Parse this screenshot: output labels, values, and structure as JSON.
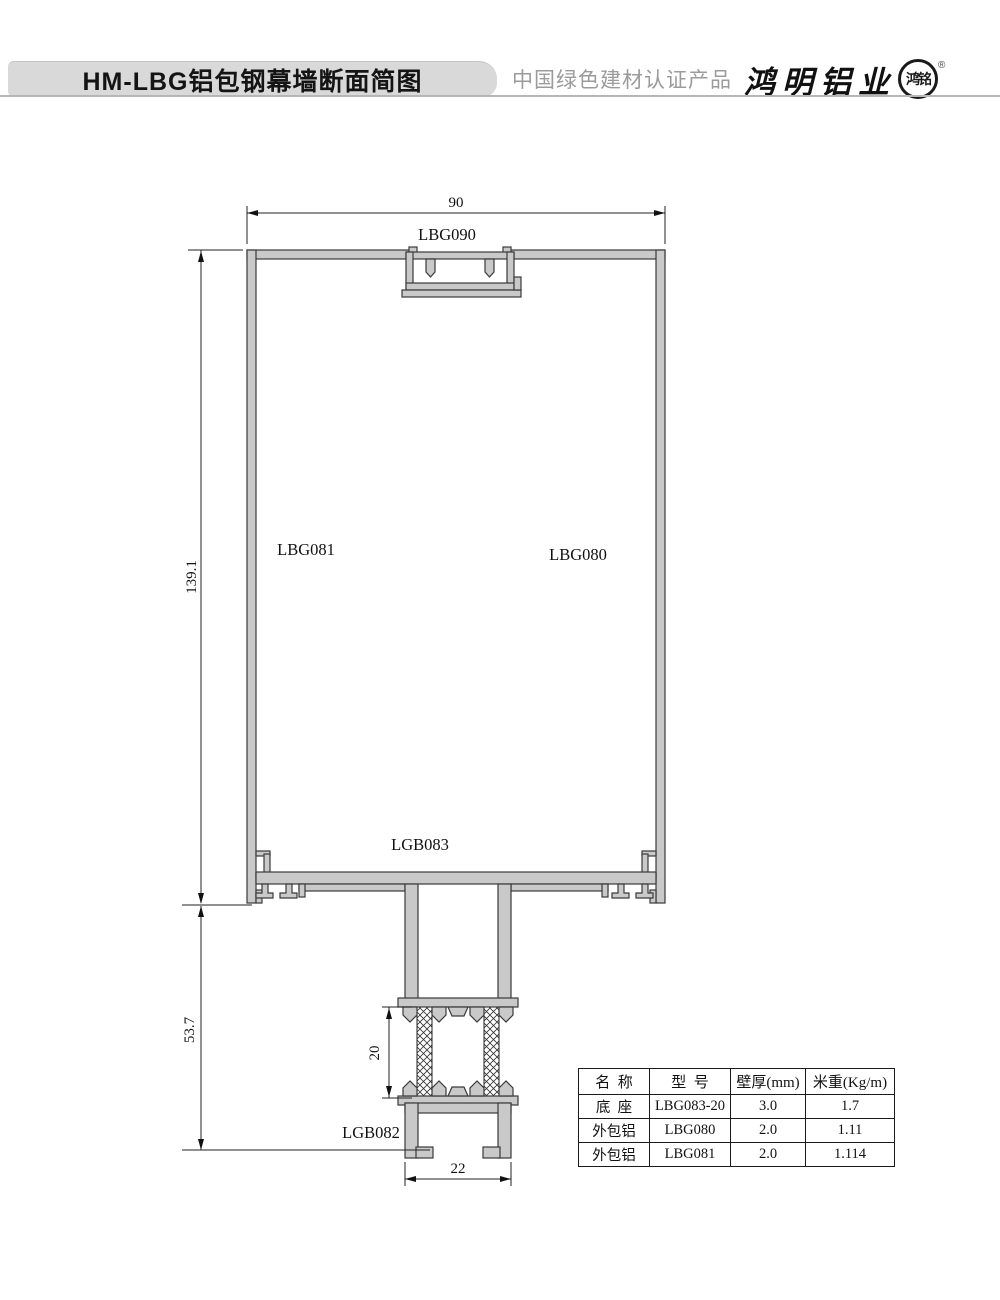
{
  "header": {
    "title": "HM-LBG铝包钢幕墙断面简图",
    "certification": "中国绿色建材认证产品",
    "brand": "鸿明铝业",
    "seal": "鸿铭",
    "registered": "®"
  },
  "drawing": {
    "dims": {
      "top_width": "90",
      "left_height": "139.1",
      "lower_height": "53.7",
      "thermal_gap": "20",
      "base_width": "22"
    },
    "labels": {
      "top_profile": "LBG090",
      "left_profile": "LBG081",
      "right_profile": "LBG080",
      "bottom_plate": "LGB083",
      "base_profile": "LGB082"
    }
  },
  "table": {
    "headers": [
      "名  称",
      "型  号",
      "壁厚(mm)",
      "米重(Kg/m)"
    ],
    "rows": [
      [
        "底  座",
        "LBG083-20",
        "3.0",
        "1.7"
      ],
      [
        "外包铝",
        "LBG080",
        "2.0",
        "1.11"
      ],
      [
        "外包铝",
        "LBG081",
        "2.0",
        "1.114"
      ]
    ]
  },
  "colors": {
    "profile_fill": "#c9c9c9",
    "profile_outline": "#3a3a3a",
    "title_bar_bg": "#d9d9d9",
    "cert_text": "#9b9b9b",
    "dimension_line": "#222222"
  }
}
